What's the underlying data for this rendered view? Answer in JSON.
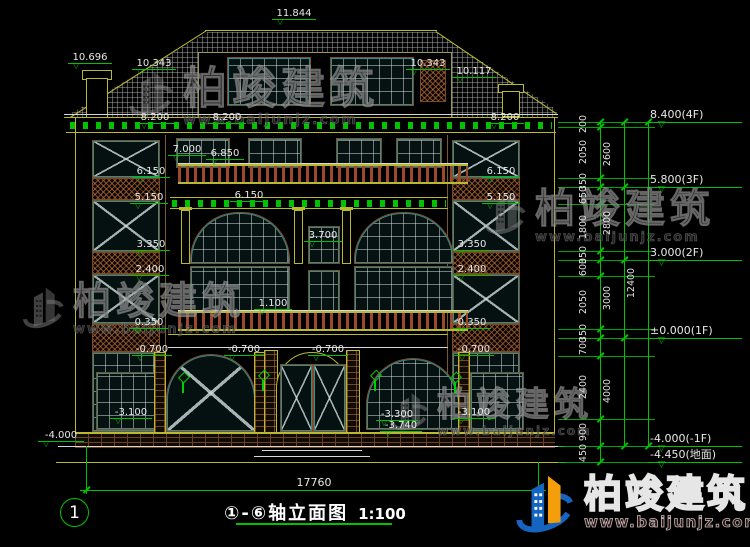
{
  "drawing": {
    "axis_title": "①-⑥轴立面图",
    "scale": "1:100",
    "grid_bubble": "1",
    "overall_width": "17760"
  },
  "watermark": {
    "name": "柏竣建筑",
    "url": "www.baijunjz.com"
  },
  "brand": {
    "name": "柏竣建筑",
    "url": "www.baijunjz.com"
  },
  "annotations": {
    "labels": [
      {
        "t": "11.844",
        "x": 272,
        "y": 8,
        "w": 44
      },
      {
        "t": "10.696",
        "x": 68,
        "y": 52,
        "w": 44
      },
      {
        "t": "10.343",
        "x": 132,
        "y": 58,
        "w": 44
      },
      {
        "t": "10.343",
        "x": 406,
        "y": 58,
        "w": 44
      },
      {
        "t": "10.117",
        "x": 452,
        "y": 66,
        "w": 44
      },
      {
        "t": "8.200",
        "x": 136,
        "y": 112,
        "w": 38
      },
      {
        "t": "8.200",
        "x": 208,
        "y": 112,
        "w": 38
      },
      {
        "t": "8.200",
        "x": 486,
        "y": 112,
        "w": 38
      },
      {
        "t": "7.000",
        "x": 168,
        "y": 144,
        "w": 38
      },
      {
        "t": "6.850",
        "x": 206,
        "y": 148,
        "w": 38
      },
      {
        "t": "6.150",
        "x": 132,
        "y": 166,
        "w": 38
      },
      {
        "t": "5.150",
        "x": 130,
        "y": 192,
        "w": 38
      },
      {
        "t": "3.350",
        "x": 132,
        "y": 239,
        "w": 38
      },
      {
        "t": "2.400",
        "x": 131,
        "y": 264,
        "w": 38
      },
      {
        "t": "0.350",
        "x": 130,
        "y": 317,
        "w": 38
      },
      {
        "t": "-0.700",
        "x": 132,
        "y": 344,
        "w": 40
      },
      {
        "t": "-3.100",
        "x": 110,
        "y": 407,
        "w": 42
      },
      {
        "t": "6.150",
        "x": 230,
        "y": 190,
        "w": 38
      },
      {
        "t": "3.700",
        "x": 304,
        "y": 230,
        "w": 38
      },
      {
        "t": "1.100",
        "x": 254,
        "y": 298,
        "w": 38
      },
      {
        "t": "-0.700",
        "x": 224,
        "y": 344,
        "w": 40
      },
      {
        "t": "-0.700",
        "x": 308,
        "y": 344,
        "w": 40
      },
      {
        "t": "-3.300",
        "x": 376,
        "y": 409,
        "w": 42
      },
      {
        "t": "-3.740",
        "x": 380,
        "y": 420,
        "w": 42
      },
      {
        "t": "6.150",
        "x": 482,
        "y": 166,
        "w": 38
      },
      {
        "t": "5.150",
        "x": 482,
        "y": 192,
        "w": 38
      },
      {
        "t": "3.350",
        "x": 453,
        "y": 239,
        "w": 38
      },
      {
        "t": "2.400",
        "x": 453,
        "y": 264,
        "w": 38
      },
      {
        "t": "0.350",
        "x": 453,
        "y": 317,
        "w": 38
      },
      {
        "t": "-0.700",
        "x": 454,
        "y": 344,
        "w": 40
      },
      {
        "t": "-3.100",
        "x": 453,
        "y": 407,
        "w": 42
      },
      {
        "t": "-4.000",
        "x": 38,
        "y": 430,
        "w": 46
      }
    ],
    "right_flags": [
      {
        "t": "8.400(4F)",
        "y": 122
      },
      {
        "t": "5.800(3F)",
        "y": 187
      },
      {
        "t": "3.000(2F)",
        "y": 260
      },
      {
        "t": "±0.000(1F)",
        "y": 338
      },
      {
        "t": "-4.000(-1F)",
        "y": 446
      },
      {
        "t": "-4.450(地面)",
        "y": 462
      }
    ],
    "dim_ticks": [
      122,
      127,
      178,
      187,
      204,
      251,
      260,
      276,
      329,
      338,
      356,
      419,
      446,
      462
    ],
    "columns": [
      {
        "x": 600,
        "segments": [
          [
            "200",
            122,
            127
          ],
          [
            "2050",
            127,
            178
          ],
          [
            "350",
            178,
            187
          ],
          [
            "650",
            187,
            204
          ],
          [
            "1800",
            204,
            251
          ],
          [
            "350",
            251,
            260
          ],
          [
            "600",
            260,
            276
          ],
          [
            "2050",
            276,
            329
          ],
          [
            "350",
            329,
            338
          ],
          [
            "700",
            338,
            356
          ],
          [
            "2400",
            356,
            419
          ],
          [
            "900",
            419,
            446
          ],
          [
            "450",
            446,
            462
          ]
        ]
      },
      {
        "x": 624,
        "segments": [
          [
            "2600",
            122,
            187
          ],
          [
            "2800",
            187,
            260
          ],
          [
            "3000",
            260,
            338
          ],
          [
            "4000",
            338,
            446
          ]
        ]
      },
      {
        "x": 648,
        "segments": [
          [
            "12400",
            122,
            446
          ]
        ]
      }
    ]
  }
}
